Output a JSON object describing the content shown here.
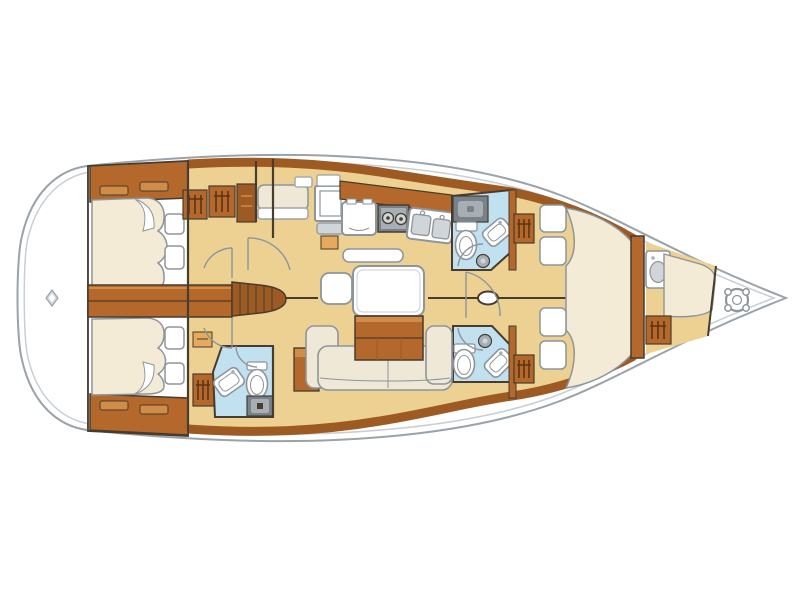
{
  "diagram": {
    "type": "yacht-interior-floor-plan",
    "orientation": "bow-right-stern-left",
    "regions": [
      {
        "id": "swim-platform",
        "name": "stern swim platform"
      },
      {
        "id": "aft-cabin-top",
        "name": "aft double cabin (top)"
      },
      {
        "id": "aft-cabin-bottom",
        "name": "aft double cabin (bottom)"
      },
      {
        "id": "companionway",
        "name": "companionway steps and engine box"
      },
      {
        "id": "aft-head",
        "name": "aft head with toilet, basin and shower"
      },
      {
        "id": "nav-station",
        "name": "chart table with seat"
      },
      {
        "id": "galley",
        "name": "galley with fridge, two-burner stove, double sink"
      },
      {
        "id": "salon",
        "name": "salon with U-sofa, table, chest, ottoman"
      },
      {
        "id": "mid-head-top",
        "name": "head with shower unit, toilet, basin"
      },
      {
        "id": "mid-head-bottom",
        "name": "head with toilet, basin"
      },
      {
        "id": "forward-cabin",
        "name": "forward cabin with V-berth, four pillows, two lockers"
      },
      {
        "id": "bow-cabin",
        "name": "bow crew cabin with berth, basin, locker"
      },
      {
        "id": "anchor-locker",
        "name": "anchor locker with windlass"
      }
    ],
    "fixture_counts": {
      "berths": 5,
      "pillows": 8,
      "toilets": 3,
      "sinks_heads": 3,
      "galley_basins": 2,
      "stove_burners": 2,
      "hanging_lockers": 6,
      "door_arcs": 7
    }
  },
  "colors": {
    "hull_stroke": "#9aa2aa",
    "hull_inner": "#c9ced3",
    "wall": "#473c2e",
    "wood": "#b4682c",
    "wood_dark": "#9d5a22",
    "wood_light": "#cf8d47",
    "floor": "#ecd193",
    "bed": "#f3ebd6",
    "sofa": "#efe8d6",
    "white": "#ffffff",
    "bath": "#c2e1f0",
    "fixture_stroke": "#8d959b",
    "gray_dark": "#79828a",
    "gray_mid": "#a7afb5",
    "gray_light": "#cfd5d9",
    "accent": "#e5aa5c",
    "hanger": "#5d3413",
    "diamond": "#d3d8dc"
  }
}
